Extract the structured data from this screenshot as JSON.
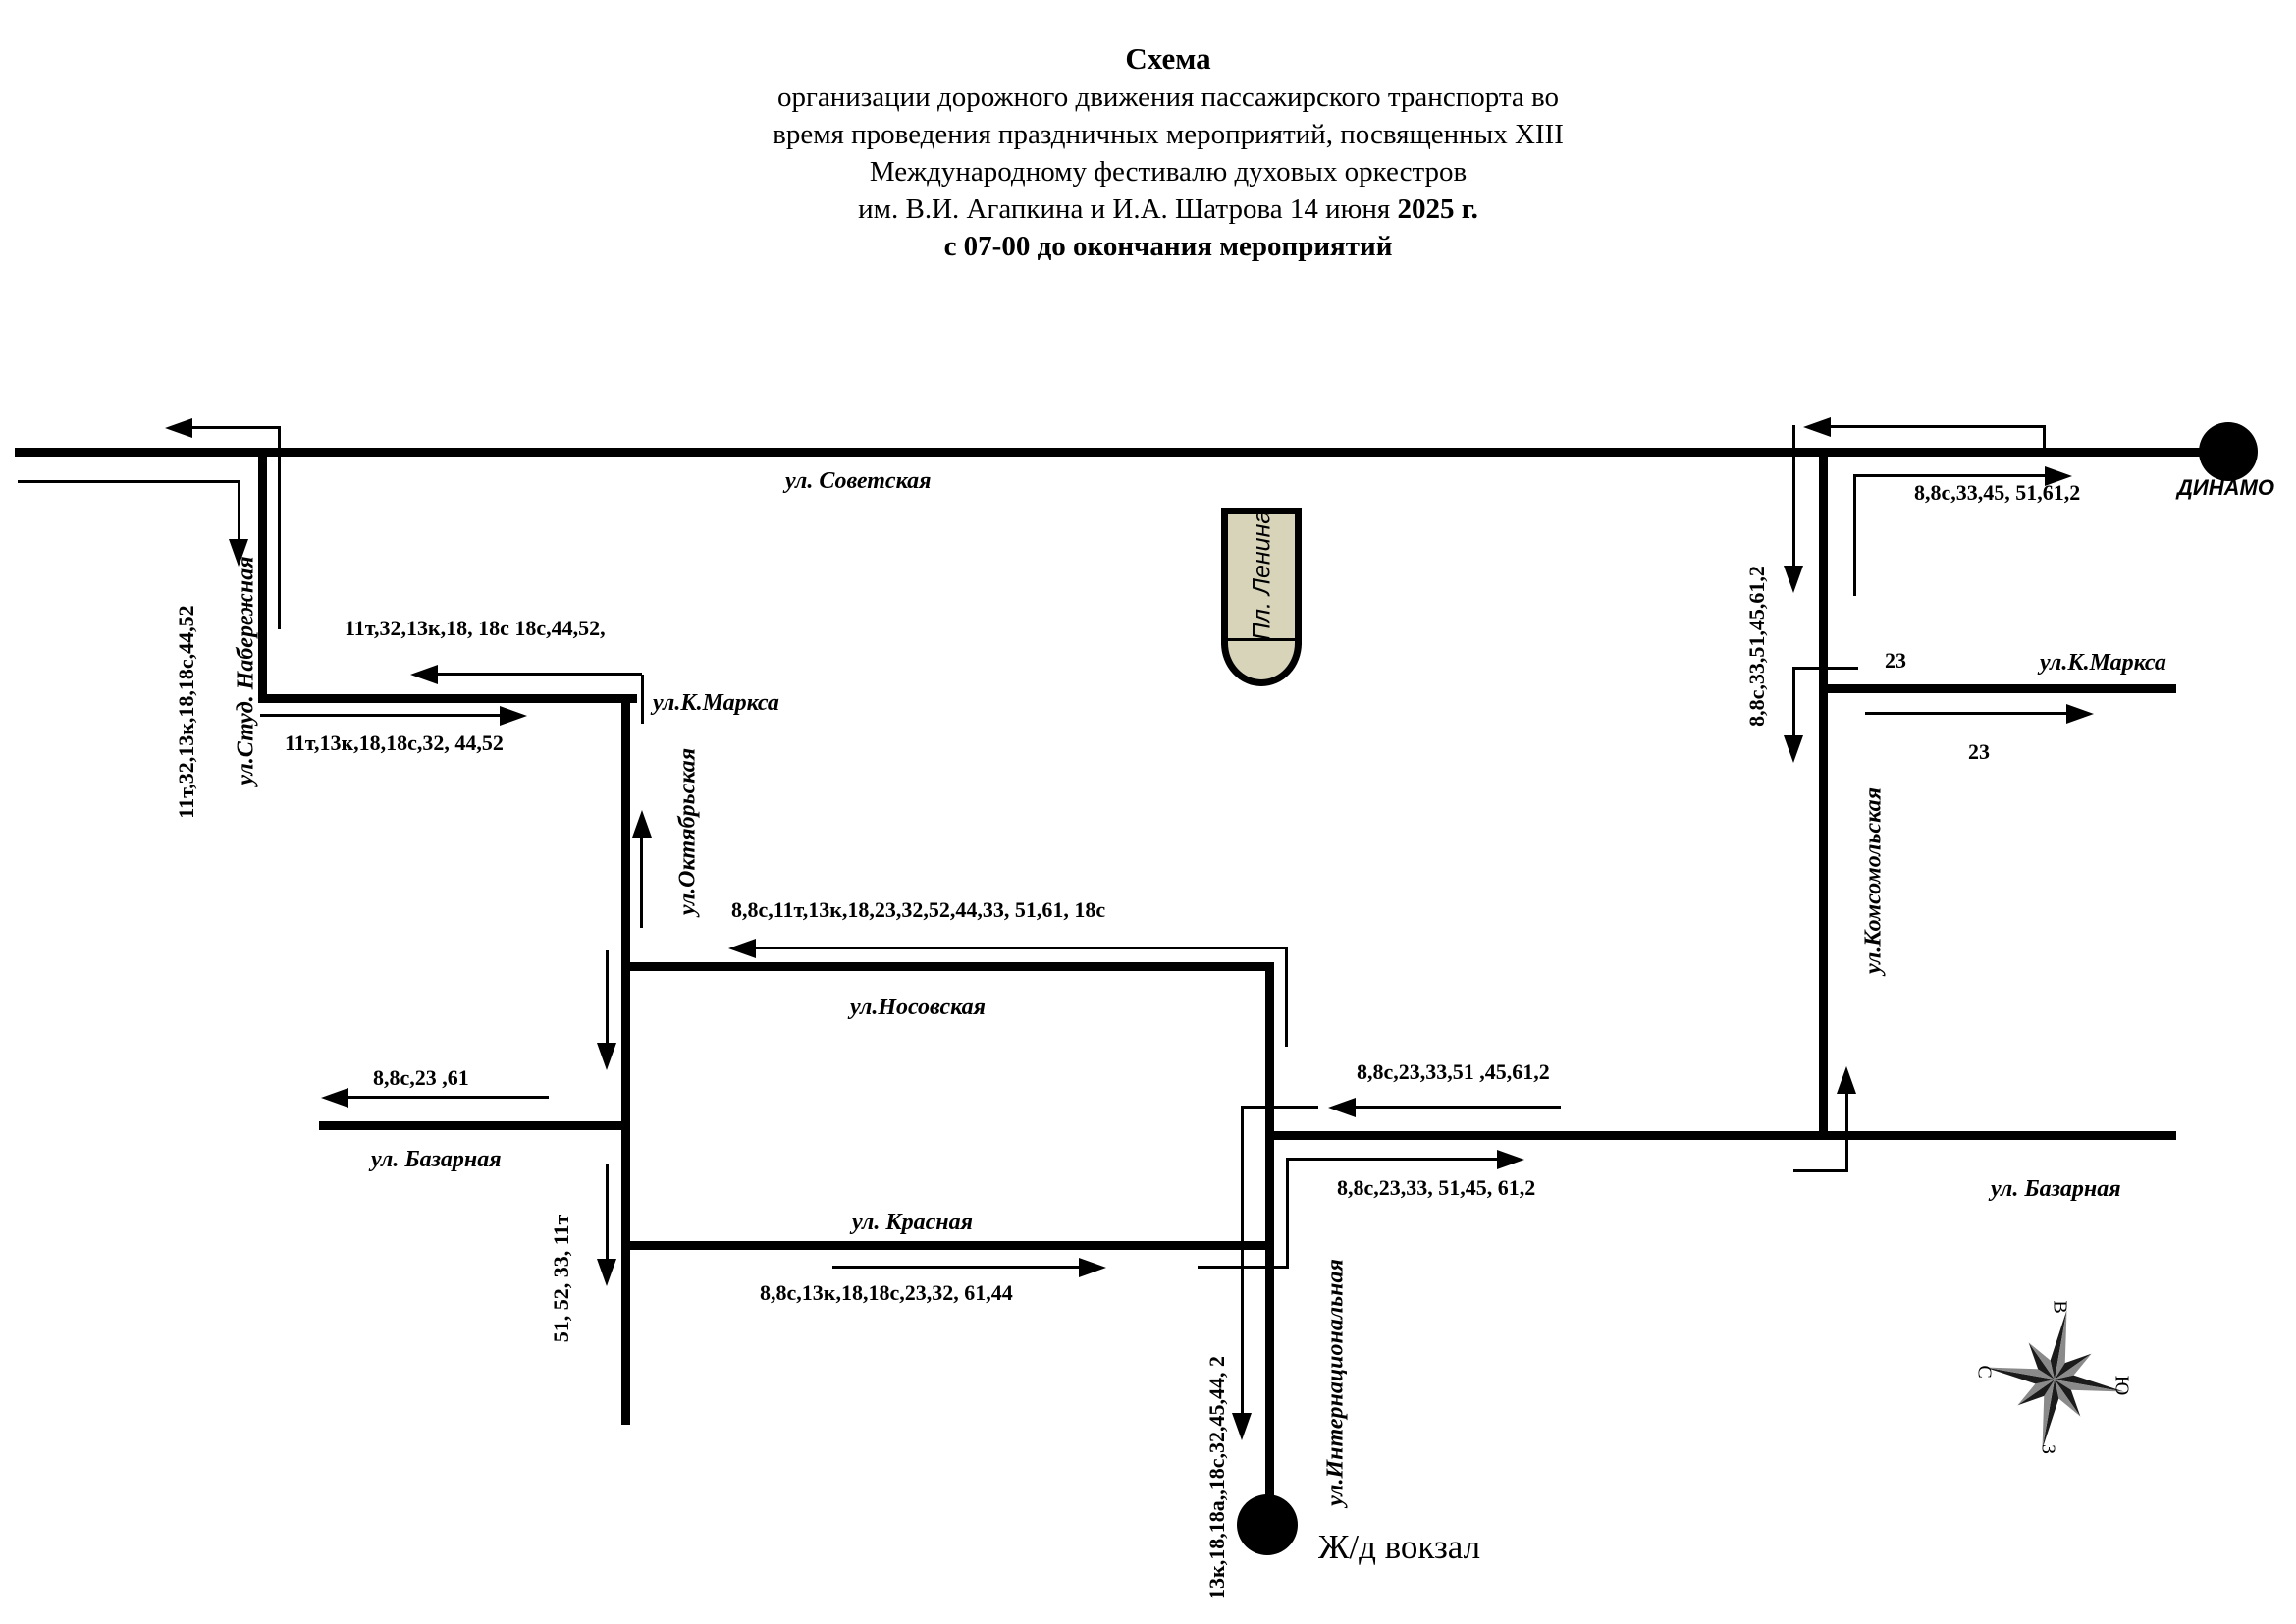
{
  "title": {
    "line1": "Схема",
    "line2": "организации дорожного движения пассажирского транспорта во",
    "line3": "время проведения праздничных мероприятий, посвященных XIII",
    "line4": "Международному фестивалю духовых оркестров",
    "line5_regular": "им. В.И. Агапкина и И.А. Шатрова 14 июня ",
    "line5_bold": "2025 г.",
    "line6": "с 07-00 до окончания мероприятий"
  },
  "streets": {
    "sovetskaya": "ул. Советская",
    "stud_naberezhnaya": "ул.Студ. Набережная",
    "k_marksa_west": "ул.К.Маркса",
    "oktyabrskaya": "ул.Октябрьская",
    "nosovskaya": "ул.Носовская",
    "bazarnaya_west": "ул. Базарная",
    "krasnaya": "ул. Красная",
    "internatsionalnaya": "ул.Интернациональная",
    "komsomolskaya": "ул.Комсомольская",
    "k_marksa_east": "ул.К.Маркса",
    "bazarnaya_east": "ул. Базарная"
  },
  "landmarks": {
    "lenin_square": "Пл. Ленина",
    "dinamo": "ДИНАМО",
    "railway_station": "Ж/д вокзал"
  },
  "routes": {
    "naberezhnaya_vert": "11т,32,13к,18,18с,44,52",
    "marksa_west_upper": "11т,32,13к,18, 18с 18с,44,52,",
    "marksa_west_lower": "11т,13к,18,18с,32, 44,52",
    "nosovskaya_west": "8,8с,11т,13к,18,23,32,52,44,33, 51,61, 18с",
    "bazarnaya_w_out": "8,8с,23 ,61",
    "oktyabrskaya_vert": "51, 52, 33, 11т",
    "krasnaya_east": "8,8с,13к,18,18с,23,32, 61,44",
    "bazarnaya_e_upper": "8,8с,23,33,51 ,45,61,2",
    "bazarnaya_e_lower": "8,8с,23,33, 51,45, 61,2",
    "station_vert": "13к,18,18а,,18с,32,45,44, 2",
    "komsomolskaya_vert": "8,8с,33,51,45,61,2",
    "dinamo_east": "8,8с,33,45, 51,61,2",
    "route23_west": "23",
    "route23_east": "23"
  },
  "compass": {
    "n": "С",
    "e": "В",
    "s": "Ю",
    "w": "З"
  },
  "colors": {
    "road": "#000000",
    "lenin_fill": "#d8d4ba",
    "background": "#ffffff"
  }
}
